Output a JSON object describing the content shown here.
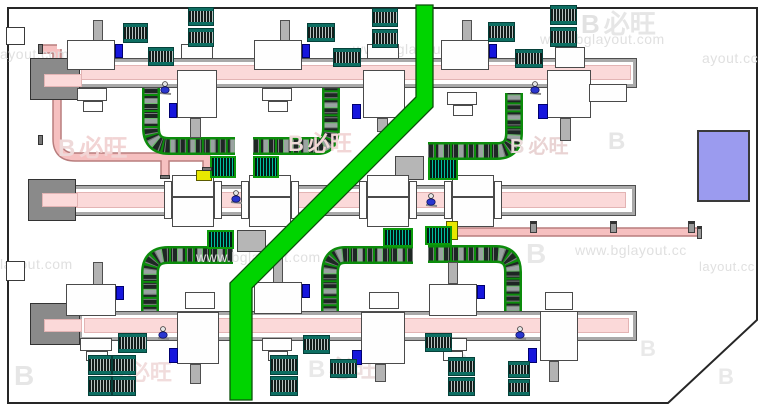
{
  "title": "factory-production-line-layout-drawing",
  "palette": {
    "aisle_green": "#00d400",
    "conveyor_pink": "#fbd9d9",
    "pipe_pink": "#f6c0c0",
    "pallet_teal": "#0d6e62",
    "control_blue": "#1616dd",
    "marker_yellow": "#e8e800",
    "storage_periwinkle": "#9b9bef",
    "structure_gray": "#a9a9a9"
  },
  "watermarks": {
    "site_text": "www.bglayout.com",
    "brand_text": "必旺",
    "texts": [
      {
        "t": "ayout.com",
        "x": 0,
        "y": 46,
        "s": 14
      },
      {
        "t": "www.bglayout.com",
        "x": 353,
        "y": 41,
        "s": 14
      },
      {
        "t": "www.bglayout.com",
        "x": 540,
        "y": 31,
        "s": 14
      },
      {
        "t": "ayout.cc",
        "x": 702,
        "y": 50,
        "s": 14
      },
      {
        "t": "layout.com",
        "x": 0,
        "y": 256,
        "s": 14
      },
      {
        "t": "www.bglayout.com",
        "x": 196,
        "y": 249,
        "s": 14
      },
      {
        "t": "www.bglayout.cc",
        "x": 575,
        "y": 242,
        "s": 14
      },
      {
        "t": "layout.cc",
        "x": 699,
        "y": 259,
        "s": 13
      }
    ],
    "logos": [
      {
        "x": 581,
        "y": 4,
        "s": 26,
        "cn": "必旺",
        "lc": "#e2e2e2",
        "tc": "#e6e6e6"
      },
      {
        "x": 58,
        "y": 128,
        "s": 24,
        "cn": "必旺",
        "lc": "#eed9d9",
        "tc": "#f2d4d4"
      },
      {
        "x": 288,
        "y": 126,
        "s": 22,
        "cn": "必旺",
        "lc": "#efdada",
        "tc": "#f2d6d6"
      },
      {
        "x": 510,
        "y": 130,
        "s": 20,
        "cn": "必旺",
        "lc": "#e9dada",
        "tc": "#e9d3d3"
      },
      {
        "x": 608,
        "y": 128,
        "s": 24,
        "cn": "",
        "lc": "#e6e6e6",
        "tc": "#e6e6e6"
      },
      {
        "x": 526,
        "y": 238,
        "s": 28,
        "cn": "",
        "lc": "#e8e8e8",
        "tc": "#e8e8e8"
      },
      {
        "x": 14,
        "y": 360,
        "s": 28,
        "cn": "",
        "lc": "#e6e6e6",
        "tc": "#e6e6e6"
      },
      {
        "x": 108,
        "y": 355,
        "s": 22,
        "cn": "必旺",
        "lc": "#efe0e0",
        "tc": "#f1dcdc"
      },
      {
        "x": 308,
        "y": 349,
        "s": 24,
        "cn": "必旺",
        "lc": "#e9e9e9",
        "tc": "#ecdede"
      },
      {
        "x": 452,
        "y": 349,
        "s": 22,
        "cn": "",
        "lc": "#e9e9e9",
        "tc": "#e9e9e9"
      },
      {
        "x": 640,
        "y": 336,
        "s": 22,
        "cn": "",
        "lc": "#e9e9e9",
        "tc": "#e9e9e9"
      },
      {
        "x": 718,
        "y": 364,
        "s": 22,
        "cn": "",
        "lc": "#e9e9e9",
        "tc": "#e9e9e9"
      },
      {
        "x": 700,
        "y": 136,
        "s": 28,
        "cn": "",
        "lc": "#8a8ae4",
        "tc": "#8a8ae4"
      }
    ]
  },
  "layout": {
    "building_outline": "8,8 757,8 757,320 668,403 8,403",
    "aisle_polygon": "416,5 433,5 433,107 252,288 252,400 230,400 230,283 416,97",
    "wall_openings": [
      [
        6,
        27,
        19,
        18,
        "whitebox"
      ],
      [
        6,
        261,
        19,
        20,
        "whitebox"
      ]
    ],
    "rects": [
      [
        75,
        58,
        562,
        30,
        "rail"
      ],
      [
        79,
        62,
        554,
        22,
        "wband"
      ],
      [
        81,
        65,
        550,
        15,
        "pinkband"
      ],
      [
        70,
        185,
        566,
        31,
        "rail"
      ],
      [
        74,
        189,
        558,
        23,
        "wband"
      ],
      [
        76,
        192,
        550,
        16,
        "pinkband"
      ],
      [
        78,
        311,
        559,
        30,
        "rail"
      ],
      [
        82,
        315,
        551,
        22,
        "wband"
      ],
      [
        84,
        318,
        545,
        15,
        "pinkband"
      ],
      [
        30,
        58,
        50,
        42,
        "endblock"
      ],
      [
        44,
        74,
        38,
        13,
        "pinkband"
      ],
      [
        28,
        179,
        48,
        42,
        "endblock"
      ],
      [
        42,
        193,
        36,
        14,
        "pinkband"
      ],
      [
        30,
        303,
        50,
        42,
        "endblock"
      ],
      [
        44,
        319,
        38,
        13,
        "pinkband"
      ],
      [
        395,
        156,
        29,
        24,
        "graybox"
      ],
      [
        237,
        230,
        29,
        22,
        "graybox"
      ],
      [
        697,
        130,
        53,
        72,
        "peri"
      ],
      [
        93,
        20,
        10,
        22,
        "stub"
      ],
      [
        67,
        40,
        48,
        30,
        "machine"
      ],
      [
        77,
        88,
        30,
        13,
        "machine"
      ],
      [
        83,
        101,
        20,
        11,
        "machine"
      ],
      [
        115,
        44,
        8,
        14,
        "blue"
      ],
      [
        280,
        20,
        10,
        22,
        "stub"
      ],
      [
        254,
        40,
        48,
        30,
        "machine"
      ],
      [
        262,
        88,
        30,
        13,
        "machine"
      ],
      [
        268,
        101,
        20,
        11,
        "machine"
      ],
      [
        302,
        44,
        8,
        14,
        "blue"
      ],
      [
        462,
        20,
        10,
        22,
        "stub"
      ],
      [
        441,
        40,
        48,
        30,
        "machine"
      ],
      [
        447,
        92,
        30,
        13,
        "machine"
      ],
      [
        453,
        105,
        20,
        11,
        "machine"
      ],
      [
        489,
        44,
        8,
        14,
        "blue"
      ],
      [
        181,
        44,
        32,
        15,
        "machine"
      ],
      [
        177,
        70,
        40,
        48,
        "machine"
      ],
      [
        190,
        118,
        11,
        20,
        "stub"
      ],
      [
        169,
        103,
        8,
        15,
        "blue"
      ],
      [
        367,
        44,
        32,
        15,
        "machine"
      ],
      [
        363,
        70,
        42,
        48,
        "machine"
      ],
      [
        377,
        118,
        11,
        14,
        "stub"
      ],
      [
        352,
        104,
        9,
        15,
        "blue"
      ],
      [
        555,
        47,
        30,
        21,
        "machine"
      ],
      [
        547,
        70,
        44,
        48,
        "machine"
      ],
      [
        589,
        84,
        38,
        18,
        "machine"
      ],
      [
        560,
        118,
        11,
        23,
        "stub"
      ],
      [
        538,
        104,
        10,
        15,
        "blue"
      ],
      [
        164,
        181,
        8,
        38,
        "machine"
      ],
      [
        172,
        175,
        42,
        22,
        "machine"
      ],
      [
        172,
        197,
        42,
        30,
        "machine"
      ],
      [
        214,
        181,
        8,
        38,
        "machine"
      ],
      [
        241,
        181,
        8,
        38,
        "machine"
      ],
      [
        249,
        175,
        42,
        22,
        "machine"
      ],
      [
        249,
        197,
        42,
        30,
        "machine"
      ],
      [
        291,
        181,
        8,
        38,
        "machine"
      ],
      [
        359,
        181,
        8,
        38,
        "machine"
      ],
      [
        367,
        175,
        42,
        22,
        "machine"
      ],
      [
        367,
        197,
        42,
        30,
        "machine"
      ],
      [
        409,
        181,
        8,
        38,
        "machine"
      ],
      [
        444,
        181,
        8,
        38,
        "machine"
      ],
      [
        452,
        175,
        42,
        22,
        "machine"
      ],
      [
        452,
        197,
        42,
        30,
        "machine"
      ],
      [
        494,
        181,
        8,
        38,
        "machine"
      ],
      [
        196,
        170,
        16,
        11,
        "yellow"
      ],
      [
        446,
        221,
        12,
        19,
        "yellow"
      ],
      [
        93,
        262,
        10,
        24,
        "stub"
      ],
      [
        66,
        284,
        50,
        32,
        "machine"
      ],
      [
        116,
        286,
        8,
        14,
        "blue"
      ],
      [
        80,
        338,
        32,
        13,
        "machine"
      ],
      [
        86,
        351,
        22,
        10,
        "machine"
      ],
      [
        273,
        258,
        10,
        26,
        "stub"
      ],
      [
        254,
        282,
        48,
        32,
        "machine"
      ],
      [
        302,
        284,
        8,
        14,
        "blue"
      ],
      [
        262,
        338,
        30,
        13,
        "machine"
      ],
      [
        268,
        351,
        20,
        10,
        "machine"
      ],
      [
        448,
        262,
        10,
        22,
        "stub"
      ],
      [
        429,
        284,
        48,
        32,
        "machine"
      ],
      [
        477,
        285,
        8,
        14,
        "blue"
      ],
      [
        437,
        338,
        30,
        13,
        "machine"
      ],
      [
        443,
        351,
        20,
        10,
        "machine"
      ],
      [
        185,
        292,
        30,
        17,
        "machine"
      ],
      [
        177,
        312,
        42,
        52,
        "machine"
      ],
      [
        190,
        364,
        11,
        20,
        "stub"
      ],
      [
        169,
        348,
        9,
        15,
        "blue"
      ],
      [
        369,
        292,
        30,
        17,
        "machine"
      ],
      [
        361,
        312,
        44,
        52,
        "machine"
      ],
      [
        375,
        364,
        11,
        18,
        "stub"
      ],
      [
        352,
        350,
        10,
        15,
        "blue"
      ],
      [
        545,
        292,
        28,
        18,
        "machine"
      ],
      [
        540,
        311,
        38,
        50,
        "machine"
      ],
      [
        549,
        361,
        10,
        21,
        "stub"
      ],
      [
        528,
        348,
        9,
        15,
        "blue"
      ],
      [
        123,
        23,
        25,
        20,
        "pallet"
      ],
      [
        148,
        47,
        26,
        19,
        "pallet"
      ],
      [
        188,
        7,
        26,
        19,
        "pallet"
      ],
      [
        188,
        28,
        26,
        19,
        "pallet"
      ],
      [
        307,
        23,
        28,
        19,
        "pallet"
      ],
      [
        333,
        48,
        28,
        19,
        "pallet"
      ],
      [
        372,
        8,
        26,
        19,
        "pallet"
      ],
      [
        372,
        29,
        26,
        19,
        "pallet"
      ],
      [
        488,
        22,
        27,
        20,
        "pallet"
      ],
      [
        515,
        49,
        28,
        19,
        "pallet"
      ],
      [
        550,
        5,
        27,
        20,
        "pallet"
      ],
      [
        550,
        27,
        27,
        20,
        "pallet"
      ],
      [
        88,
        355,
        24,
        20,
        "pallet"
      ],
      [
        112,
        355,
        24,
        20,
        "pallet"
      ],
      [
        88,
        376,
        24,
        20,
        "pallet"
      ],
      [
        112,
        376,
        24,
        20,
        "pallet"
      ],
      [
        118,
        333,
        29,
        20,
        "pallet"
      ],
      [
        270,
        355,
        28,
        20,
        "pallet"
      ],
      [
        270,
        376,
        28,
        20,
        "pallet"
      ],
      [
        303,
        335,
        27,
        19,
        "pallet"
      ],
      [
        330,
        359,
        27,
        19,
        "pallet"
      ],
      [
        425,
        333,
        27,
        19,
        "pallet"
      ],
      [
        448,
        357,
        27,
        19,
        "pallet"
      ],
      [
        448,
        377,
        27,
        19,
        "pallet"
      ],
      [
        508,
        361,
        22,
        17,
        "pallet"
      ],
      [
        508,
        379,
        22,
        17,
        "pallet"
      ],
      [
        210,
        156,
        26,
        22,
        "dotpal"
      ],
      [
        253,
        156,
        26,
        22,
        "dotpal"
      ],
      [
        428,
        158,
        30,
        22,
        "dotpal"
      ],
      [
        207,
        230,
        27,
        19,
        "dotpal"
      ],
      [
        383,
        228,
        30,
        19,
        "dotpal"
      ],
      [
        425,
        226,
        27,
        19,
        "dotpal"
      ],
      [
        530,
        221,
        7,
        12,
        "post"
      ],
      [
        610,
        221,
        7,
        12,
        "post"
      ],
      [
        688,
        221,
        7,
        12,
        "post"
      ],
      [
        697,
        226,
        5,
        13,
        "post"
      ],
      [
        38,
        44,
        5,
        10,
        "cap"
      ],
      [
        38,
        135,
        5,
        10,
        "cap"
      ],
      [
        160,
        175,
        10,
        4,
        "cap"
      ],
      [
        202,
        167,
        10,
        4,
        "cap"
      ]
    ],
    "curve_conveyors": [
      "M151,88 L151,128 Q151,146 169,146 L235,146",
      "M253,146 L318,146 Q331,146 331,128 L331,88",
      "M428,151 L497,151 Q514,151 514,133 L514,93",
      "M233,255 L168,255 Q150,255 150,273 L150,312",
      "M413,255 L345,255 Q330,255 330,273 L330,311",
      "M428,254 L496,254 Q513,254 513,272 L513,312"
    ],
    "pipes": [
      "M41,49 L57,49 M57,49 L57,139 Q57,157 75,157 L211,157 M165,157 L165,177 M207,157 L207,170",
      "M457,232 L699,232"
    ],
    "workers": [
      [
        165,
        84
      ],
      [
        535,
        84
      ],
      [
        236,
        193
      ],
      [
        431,
        196
      ],
      [
        163,
        329
      ],
      [
        520,
        329
      ]
    ]
  }
}
